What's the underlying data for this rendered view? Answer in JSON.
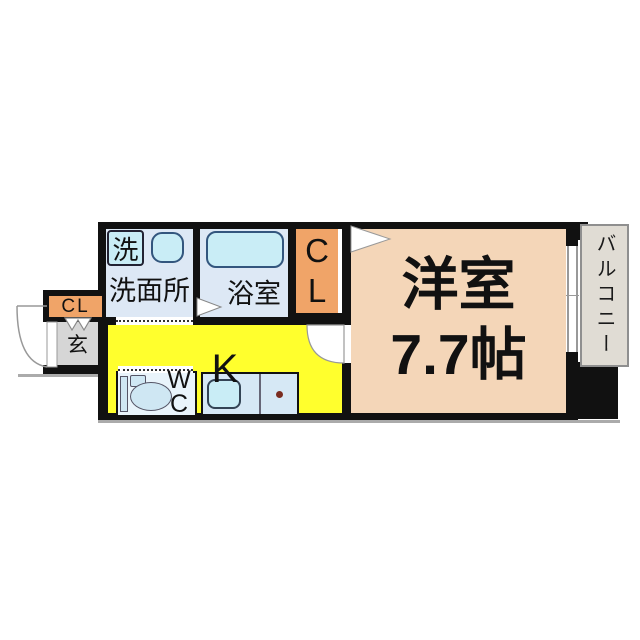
{
  "colors": {
    "wall": "#111111",
    "ink": "#111111",
    "wet": "#dde8f5",
    "fixture": "#c9edf6",
    "fixture-border": "#33567e",
    "closet": "#f0a468",
    "entrance-bg": "#d6d6d6",
    "kitchen": "#ffff2d",
    "room": "#f4d6b8",
    "balcony-bg": "#e0dcd4",
    "balcony-border": "#8f8f8f",
    "toilet-bg": "#e9f4fb",
    "counter-bg": "#d6e8f5",
    "door-line": "#999999",
    "stove": "#7a2c20",
    "shadow": "#ababab"
  },
  "rooms": {
    "washroom": {
      "label": "洗面所"
    },
    "washer": {
      "label": "洗"
    },
    "bathroom": {
      "label": "浴室"
    },
    "closet_main": {
      "line1": "C",
      "line2": "L"
    },
    "closet_entrance": {
      "label": "CL"
    },
    "entrance": {
      "label": "玄"
    },
    "kitchen": {
      "label": "K"
    },
    "toilet": {
      "line1": "W",
      "line2": "C"
    },
    "main_room": {
      "name": "洋室",
      "size": "7.7帖"
    },
    "balcony": {
      "label": "バルコニー"
    }
  }
}
